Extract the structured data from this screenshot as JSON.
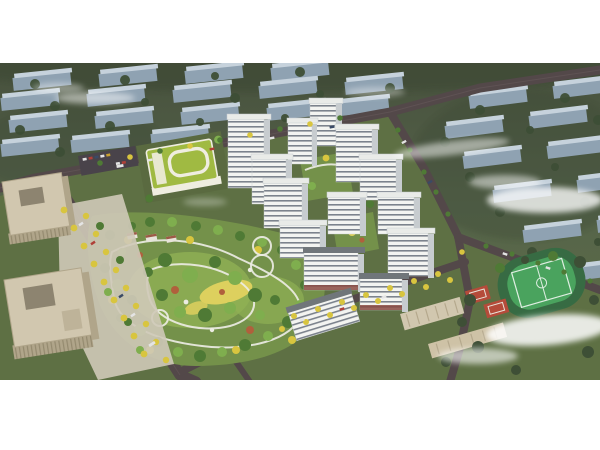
{
  "image": {
    "kind": "architectural-aerial-rendering",
    "description": "Bird's-eye masterplan rendering of a residential development: white high-rise towers around landscaped courtyards, a large central park with winding paths and autumn trees, a green-roof kindergarten, beige office towers at west, a school with football pitch and basketball courts at southeast, tree-lined boulevards, muted grey context housing blocks and drifting clouds.",
    "frame": {
      "canvas_w": 600,
      "canvas_h": 450,
      "render_top": 63,
      "render_height": 317,
      "margin_color": "#ffffff"
    }
  },
  "palette": {
    "paper": "#ffffff",
    "bg-olive-1": "#47513d",
    "bg-olive-2": "#57654426",
    "bg-mass": "#3d4936",
    "site-green": "#5e7044",
    "park-green": "#74914a",
    "lawn-light": "#90b054",
    "meadow-yellow": "#ddd05e",
    "path-white": "#ecece3",
    "tree-dark": "#3e4f36",
    "tree-green": "#4f7a35",
    "tree-light": "#7fae4e",
    "tree-yellow": "#d8c53f",
    "tree-red": "#b0603c",
    "slab-face": "#8fa2b2",
    "slab-top": "#c6d2dc",
    "road": "#534849",
    "road-light": "#6a5c5e",
    "sidewalk": "#cfc9b8",
    "tower-face": "#f3f4f1",
    "tower-window": "#67707c",
    "tower-side": "#c7cccf",
    "tower-roof": "#e9ebe8",
    "slab-roof-dark": "#70767a",
    "retail-red": "#8a4a42",
    "office-beige": "#d1c7af",
    "office-side": "#b0a58a",
    "office-inset": "#8d8470",
    "school-roof": "#a0ba42",
    "school-trim": "#efede0",
    "field-ring": "#376b43",
    "field-green": "#4aa35e",
    "field-line": "#dfeee2",
    "court-red": "#b54b3a",
    "court-green": "#3f8f55",
    "cloud": "#ffffff",
    "car-white": "#e4e4e4",
    "car-red": "#b04038",
    "car-dark": "#3a4a66",
    "car-yellow": "#c8a030",
    "parking": "#49434a",
    "village-roof": "#9c5a46"
  },
  "scene": {
    "regions": [
      {
        "name": "context-housing-north",
        "desc": "rows of muted blue-grey slab blocks among dark trees"
      },
      {
        "name": "context-housing-east",
        "desc": "more grey slab blocks fading into fog"
      },
      {
        "name": "residential-tower-cluster",
        "tower_count": 13,
        "facade": "white with dark window bands"
      },
      {
        "name": "courtyard-gardens",
        "desc": "green podium decks with play areas between towers"
      },
      {
        "name": "central-park",
        "features": [
          "winding white loop paths",
          "yellow meadow",
          "mixed green and autumn trees",
          "round plazas"
        ]
      },
      {
        "name": "kindergarten-green-roof",
        "desc": "low building with bright green roof and white loop"
      },
      {
        "name": "office-towers-west",
        "count": 2,
        "color": "beige, seen from above with inset roof courts"
      },
      {
        "name": "school-and-sports-southeast",
        "features": [
          "football pitch with track",
          "red basketball courts",
          "beige classroom slabs"
        ]
      },
      {
        "name": "boulevard-yellow-trees-west",
        "desc": "wide avenue densely lined with yellow trees"
      },
      {
        "name": "clouds",
        "count": 7
      }
    ]
  }
}
